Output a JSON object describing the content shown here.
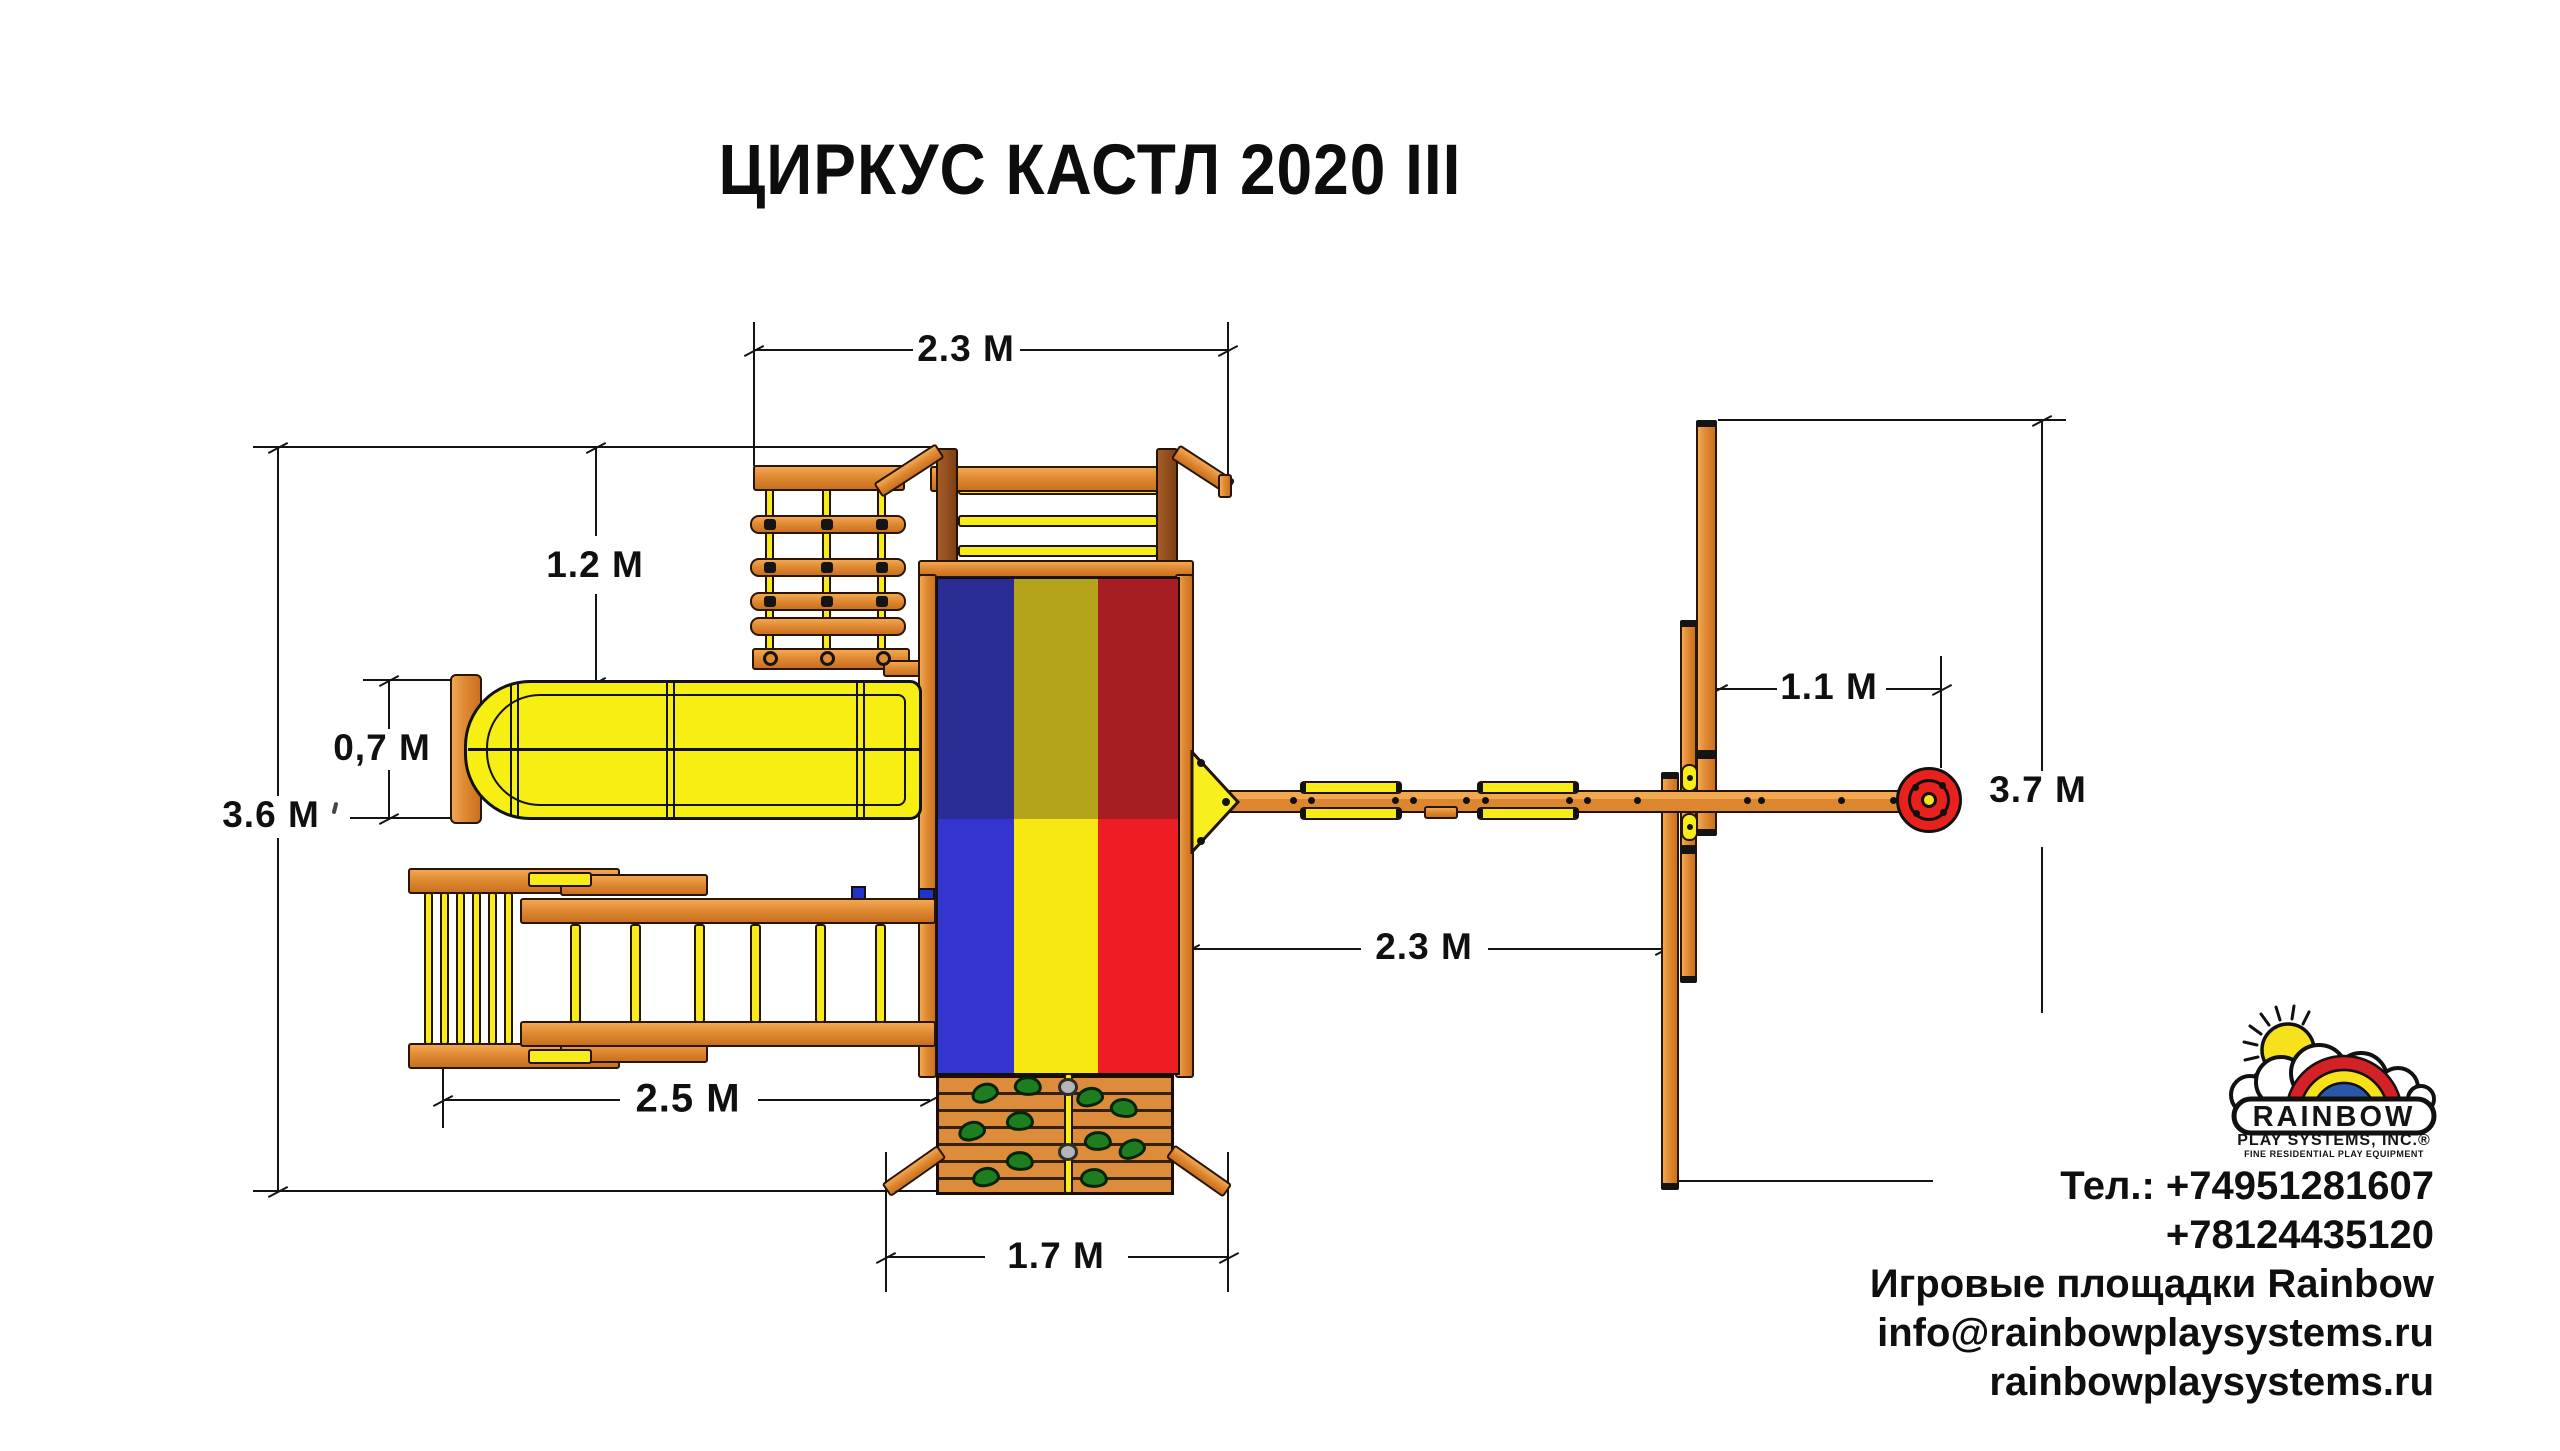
{
  "title": "ЦИРКУС КАСТЛ 2020 III",
  "dimensions": {
    "top_span": {
      "label": "2.3 M"
    },
    "deck_offset": {
      "label": "1.2 M"
    },
    "slide_width": {
      "label": "0,7 M"
    },
    "total_depth": {
      "label": "3.6 M"
    },
    "ramp_length": {
      "label": "2.5 M"
    },
    "wall_width": {
      "label": "1.7 M"
    },
    "swing_bay": {
      "label": "2.3 M"
    },
    "tire_offset": {
      "label": "1.1 M"
    },
    "total_width": {
      "label": "3.7 M"
    }
  },
  "logo": {
    "brand": "RAINBOW",
    "company": "PLAY SYSTEMS, INC.®",
    "tagline": "FINE RESIDENTIAL PLAY EQUIPMENT"
  },
  "contact": {
    "phone1": "Тел.: +74951281607",
    "phone2": "+78124435120",
    "line3": "Игровые площадки Rainbow",
    "email": "info@rainbowplaysystems.ru",
    "site": "rainbowplaysystems.ru"
  },
  "colors": {
    "wood": "#e08a33",
    "wood_dark": "#8a4b20",
    "outline": "#241303",
    "accent_yellow": "#f7ec1a",
    "dim_line": "#141414",
    "flag_blue_dark": "#2b2b94",
    "flag_gold_dark": "#b3a41c",
    "flag_red_dark": "#a61e24",
    "flag_blue": "#3434cf",
    "flag_yellow": "#f7e713",
    "flag_red": "#ee1c25",
    "tire_red": "#e8211c",
    "holds_green": "#1e7d1e",
    "logo_red": "#d42027",
    "logo_yellow": "#f7e11c",
    "logo_blue": "#2b57a8"
  }
}
